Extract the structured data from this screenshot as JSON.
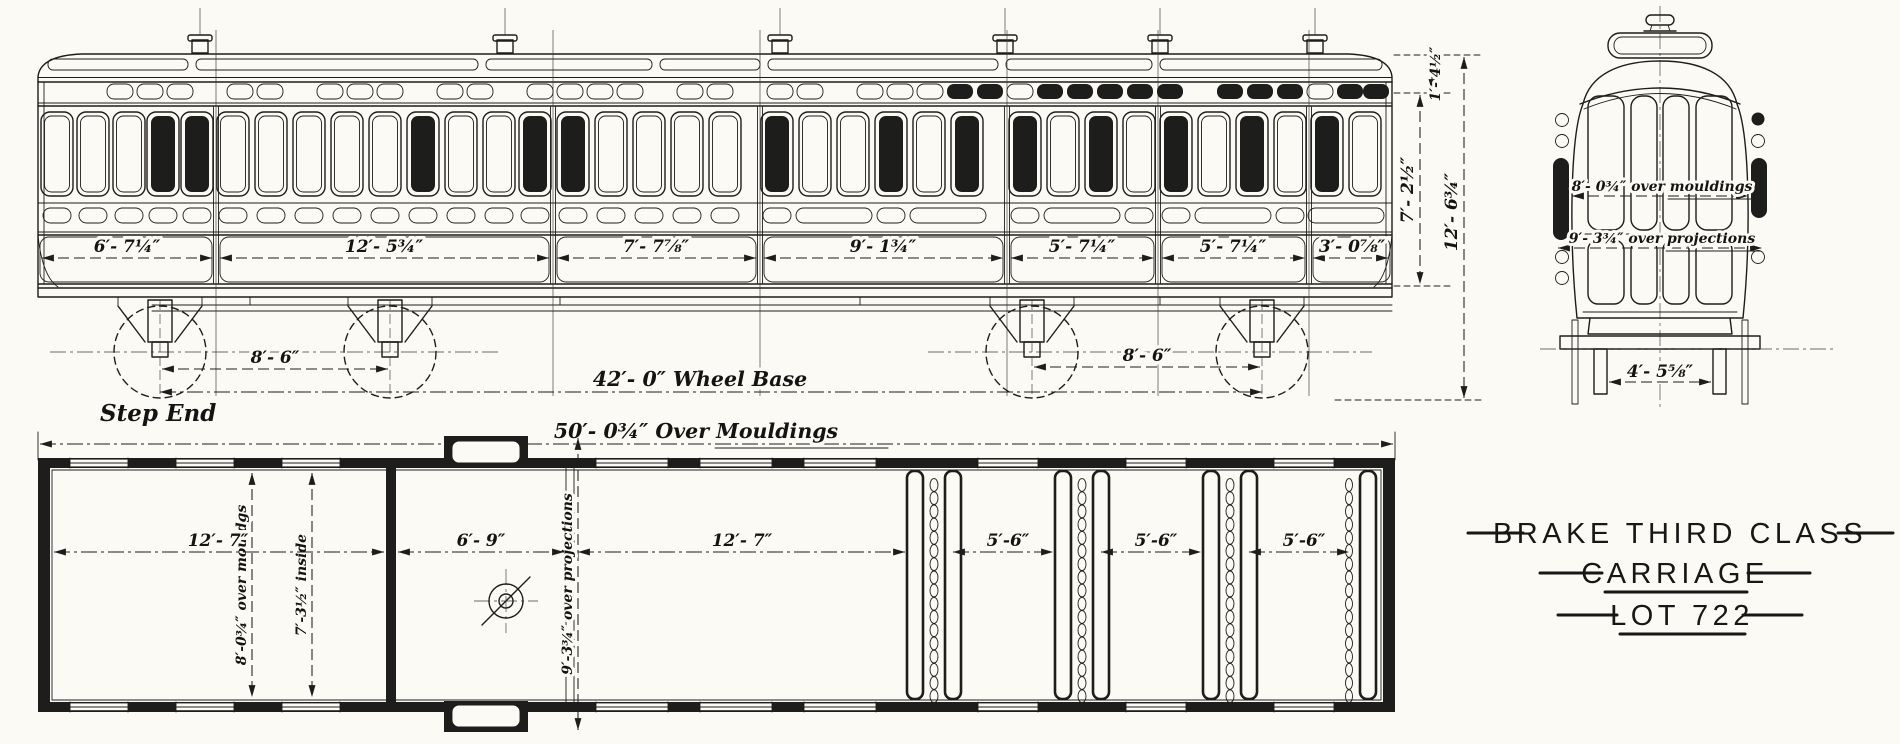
{
  "title": {
    "line1": "BRAKE THIRD CLASS",
    "line2": "CARRIAGE",
    "line3": "LOT 722"
  },
  "side_elevation": {
    "panel_dims": [
      "6′- 7¼″",
      "12′- 5¾″",
      "7′- 7⅞″",
      "9′- 1¾″",
      "5′- 7¼″",
      "5′- 7¼″",
      "3′- 0⅞″"
    ],
    "bogie_spacing_left": "8′- 6″",
    "bogie_spacing_right": "8′- 6″",
    "wheel_base": "42′- 0″ Wheel Base",
    "step_end_label": "Step End",
    "cornice_height": "1′- 4½″",
    "body_height": "7′- 2½″",
    "total_height": "12′- 6¾″"
  },
  "end_elevation": {
    "width_over_mouldings": "8′- 0¾″ over mouldings",
    "width_over_projections": "9′- 3¾″ over projections",
    "rail_gauge": "4′- 5⅝″"
  },
  "plan": {
    "overall_length": "50′- 0¾″ Over Mouldings",
    "luggage_length": "12′- 7″",
    "guard_length": "6′- 9″",
    "saloon_length": "12′- 7″",
    "compartment_lengths": [
      "5′-6″",
      "5′-6″",
      "5′-6″"
    ],
    "width_over_mouldings": "8′-0¾″ over mouldgs",
    "width_inside": "7′-3½″ inside",
    "width_over_projections": "9′-3¾″ over projections"
  },
  "colors": {
    "ink": "#1d1d1b",
    "paper": "#fbfaf4"
  }
}
